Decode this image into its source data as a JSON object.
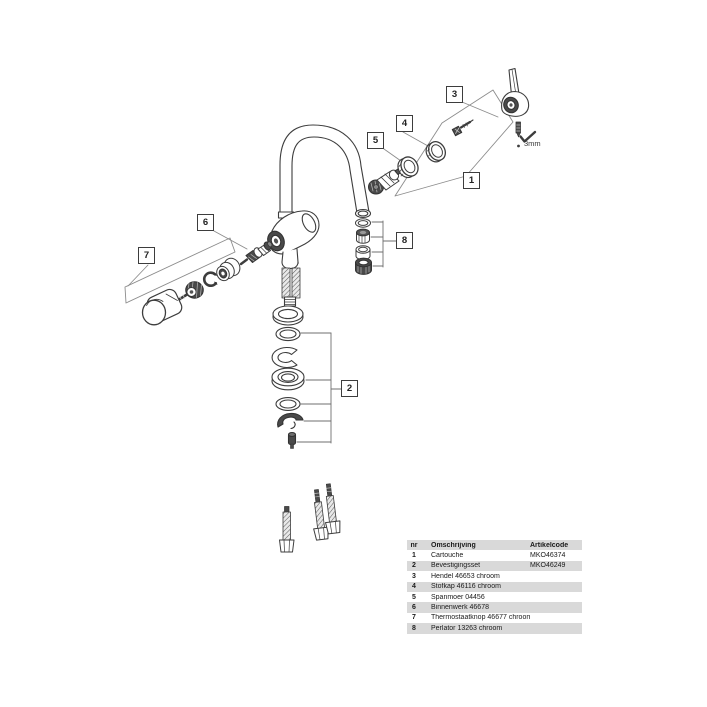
{
  "diagram": {
    "callouts": [
      {
        "label": "1"
      },
      {
        "label": "2"
      },
      {
        "label": "3"
      },
      {
        "label": "4"
      },
      {
        "label": "5"
      },
      {
        "label": "6"
      },
      {
        "label": "7"
      },
      {
        "label": "8"
      }
    ],
    "size_annotation": "3mm"
  },
  "parts_table": {
    "headers": {
      "nr": "nr",
      "description": "Omschrijving",
      "code": "Artikelcode"
    },
    "rows": [
      {
        "nr": "1",
        "description": "Cartouche",
        "code": "MKO46374"
      },
      {
        "nr": "2",
        "description": "Bevestigingsset",
        "code": "MKO46249"
      },
      {
        "nr": "3",
        "description": "Hendel 46653 chroom",
        "code": ""
      },
      {
        "nr": "4",
        "description": "Stofkap 46116 chroom",
        "code": ""
      },
      {
        "nr": "5",
        "description": "Spanmoer 04456",
        "code": ""
      },
      {
        "nr": "6",
        "description": "Binnenwerk 46678",
        "code": ""
      },
      {
        "nr": "7",
        "description": "Thermostaatknop 46677 chroom",
        "code": ""
      },
      {
        "nr": "8",
        "description": "Perlator 13263 chroom",
        "code": ""
      }
    ]
  },
  "colors": {
    "line_dark": "#3d3d3d",
    "line_guide": "#8c8c8c",
    "part_dark_fill": "#4a4a4a",
    "table_row_alt": "#d9d9d9",
    "text": "#1a1a1a"
  }
}
